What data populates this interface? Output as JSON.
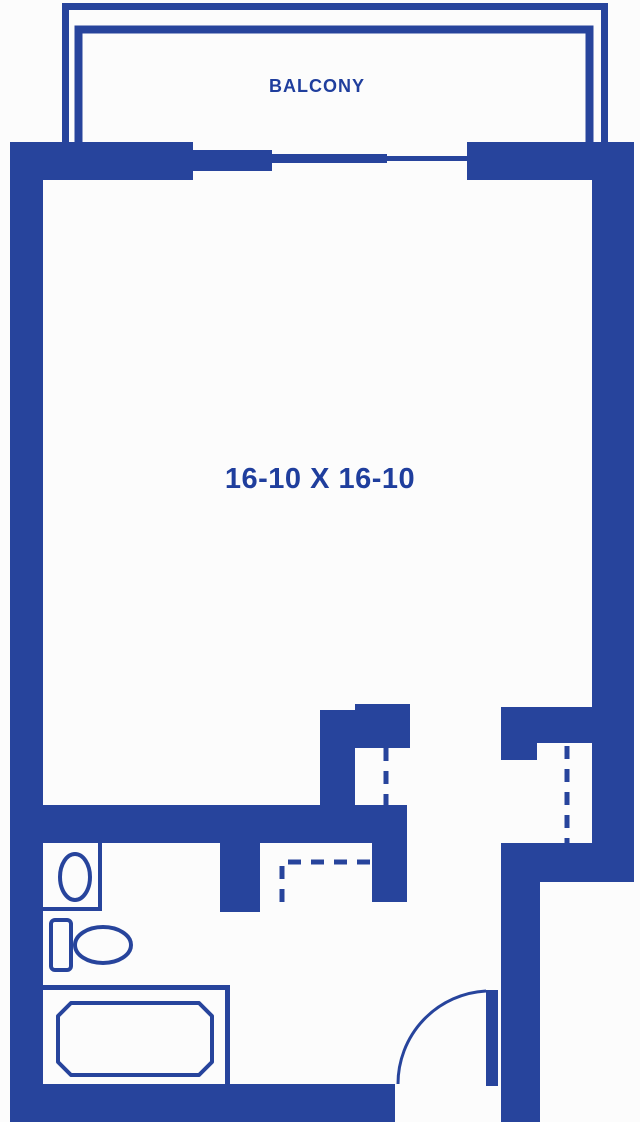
{
  "labels": {
    "balcony": "BALCONY",
    "room_dimensions": "16-10 X 16-10"
  },
  "colors": {
    "wall": "#27449c",
    "text": "#1f3e9d",
    "background": "#fcfcfc"
  },
  "plan": {
    "type": "apartment-floor-plan",
    "visible_symbols": [
      "balcony-railing",
      "sliding-balcony-door",
      "toilet-icon",
      "sink-icon",
      "bathtub-icon",
      "dashed-closet-doors",
      "entry-door-swing-arc"
    ]
  }
}
